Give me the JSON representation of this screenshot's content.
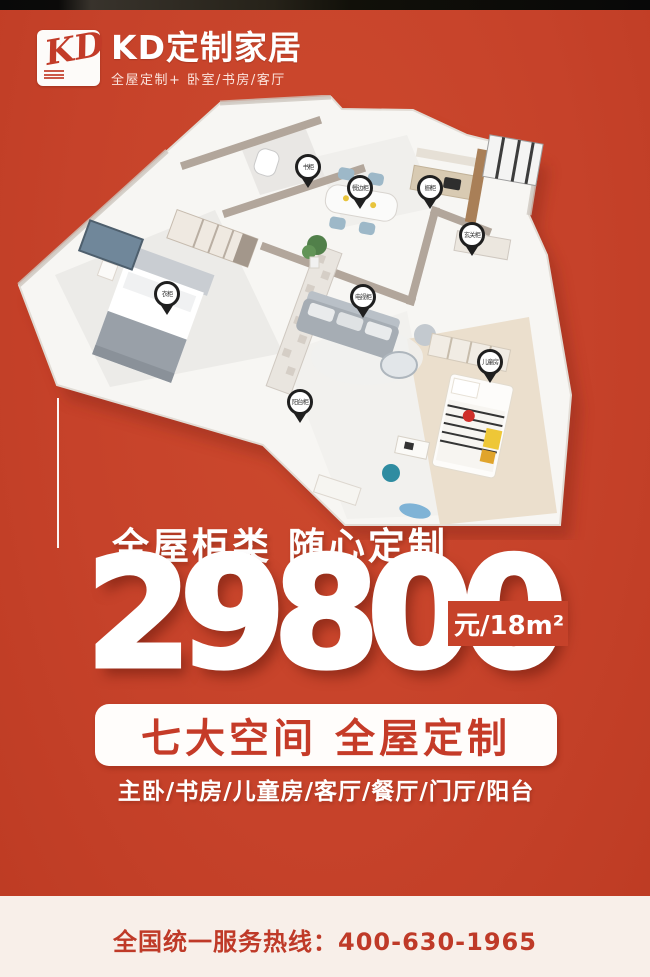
{
  "colors": {
    "background": "#c6422a",
    "accent_red": "#bf3a28",
    "footer_bg": "#f8efe9",
    "top_strip": "#161310"
  },
  "header": {
    "logo_text": "KD",
    "brand": "KD定制家居",
    "tagline": "全屋定制+ 卧室/书房/客厅"
  },
  "floorplan": {
    "pins": [
      {
        "label": "书柜"
      },
      {
        "label": "餐边柜"
      },
      {
        "label": "橱柜"
      },
      {
        "label": "玄关柜"
      },
      {
        "label": "衣柜"
      },
      {
        "label": "电视柜"
      },
      {
        "label": "儿童房"
      },
      {
        "label": "阳台柜"
      }
    ]
  },
  "promo": {
    "headline": "全屋柜类 随心定制",
    "price": "29800",
    "price_unit": "元/18m²",
    "banner": "七大空间 全屋定制",
    "spaces": "主卧/书房/儿童房/客厅/餐厅/门厅/阳台"
  },
  "footer": {
    "hotline": "全国统一服务热线：400-630-1965"
  }
}
